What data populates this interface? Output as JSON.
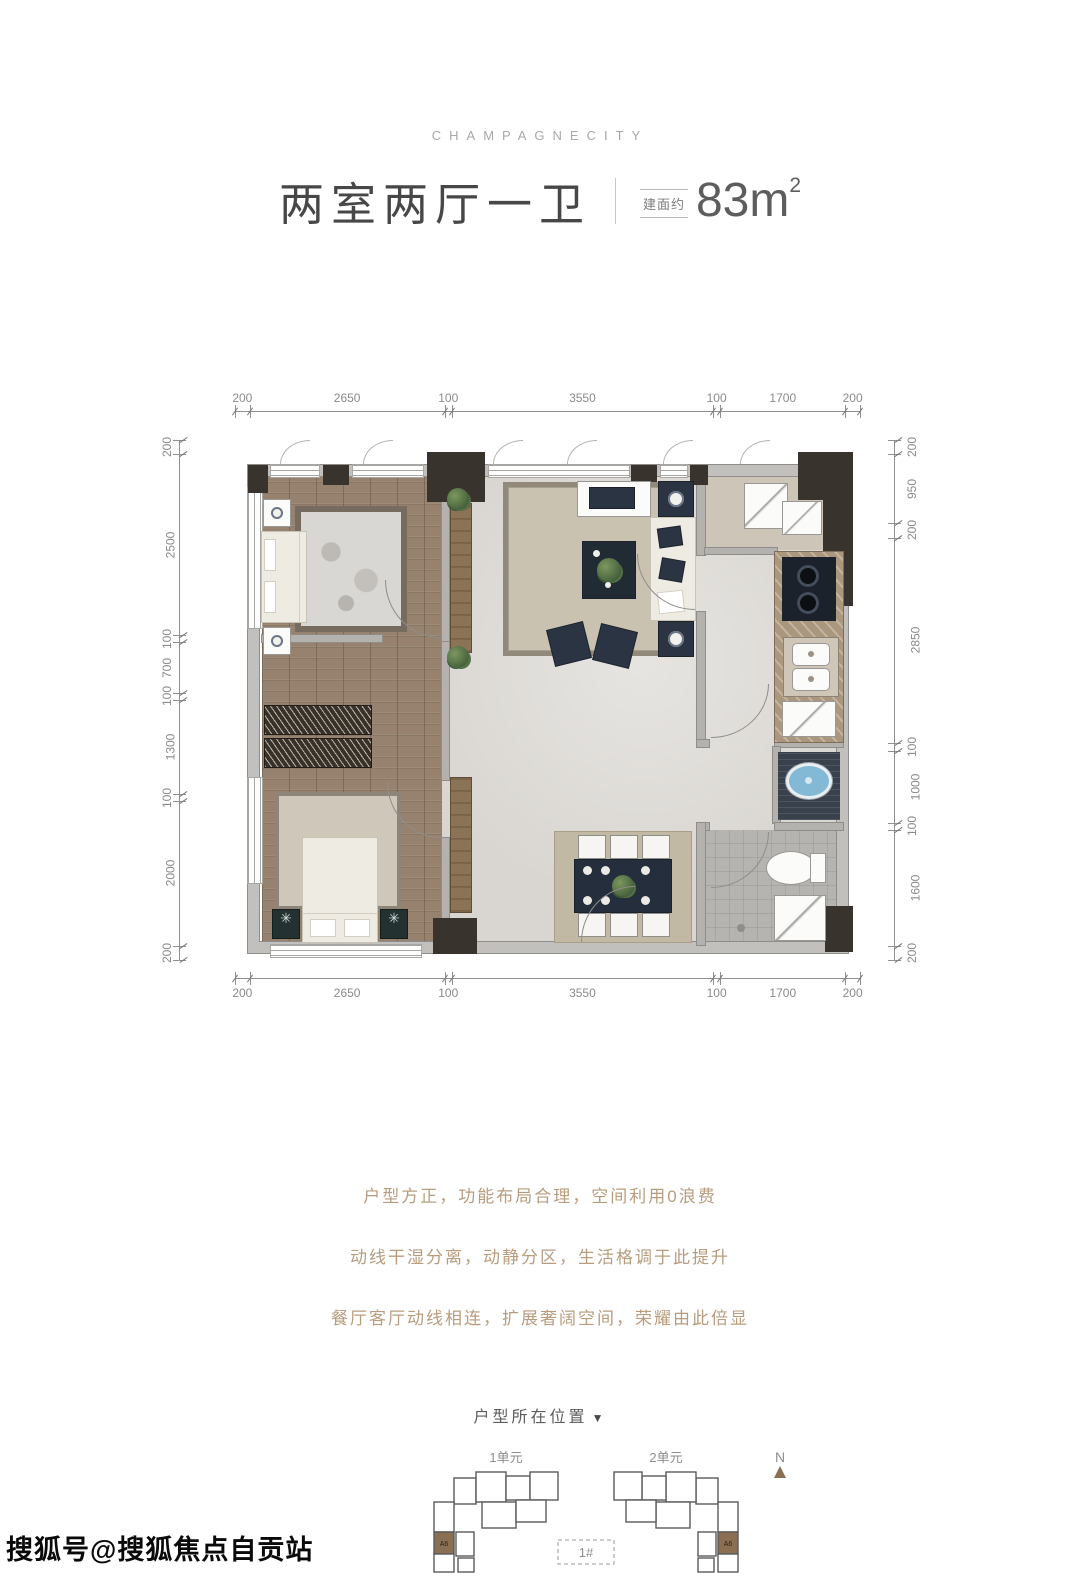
{
  "header": {
    "brand": "CHAMPAGNECITY",
    "title": "两室两厅一卫",
    "area_label": "建面约",
    "area_value": "83m",
    "area_sup": "2"
  },
  "floorplan": {
    "dims_top": [
      200,
      2650,
      100,
      3550,
      100,
      1700,
      200
    ],
    "dims_bottom": [
      200,
      2650,
      100,
      3550,
      100,
      1700,
      200
    ],
    "dims_left": [
      200,
      2500,
      100,
      700,
      100,
      1300,
      100,
      2000,
      200
    ],
    "dims_right": [
      200,
      950,
      200,
      2850,
      100,
      1000,
      100,
      1600,
      200
    ]
  },
  "description": {
    "lines": [
      "户型方正，功能布局合理，空间利用0浪费",
      "动线干湿分离，动静分区，生活格调于此提升",
      "餐厅客厅动线相连，扩展奢阔空间，荣耀由此倍显"
    ]
  },
  "location": {
    "title": "户型所在位置",
    "arrow": "▼",
    "unit1": "1单元",
    "unit2": "2单元",
    "building": "1#",
    "compass": "N",
    "cell": "A6"
  },
  "watermark": "搜狐号@搜狐焦点自贡站",
  "colors": {
    "accent_text": "#b89c7e",
    "navy_furniture": "#2b3442",
    "wood_floor": "#96826e",
    "highlight_cell": "#8a6f52"
  }
}
